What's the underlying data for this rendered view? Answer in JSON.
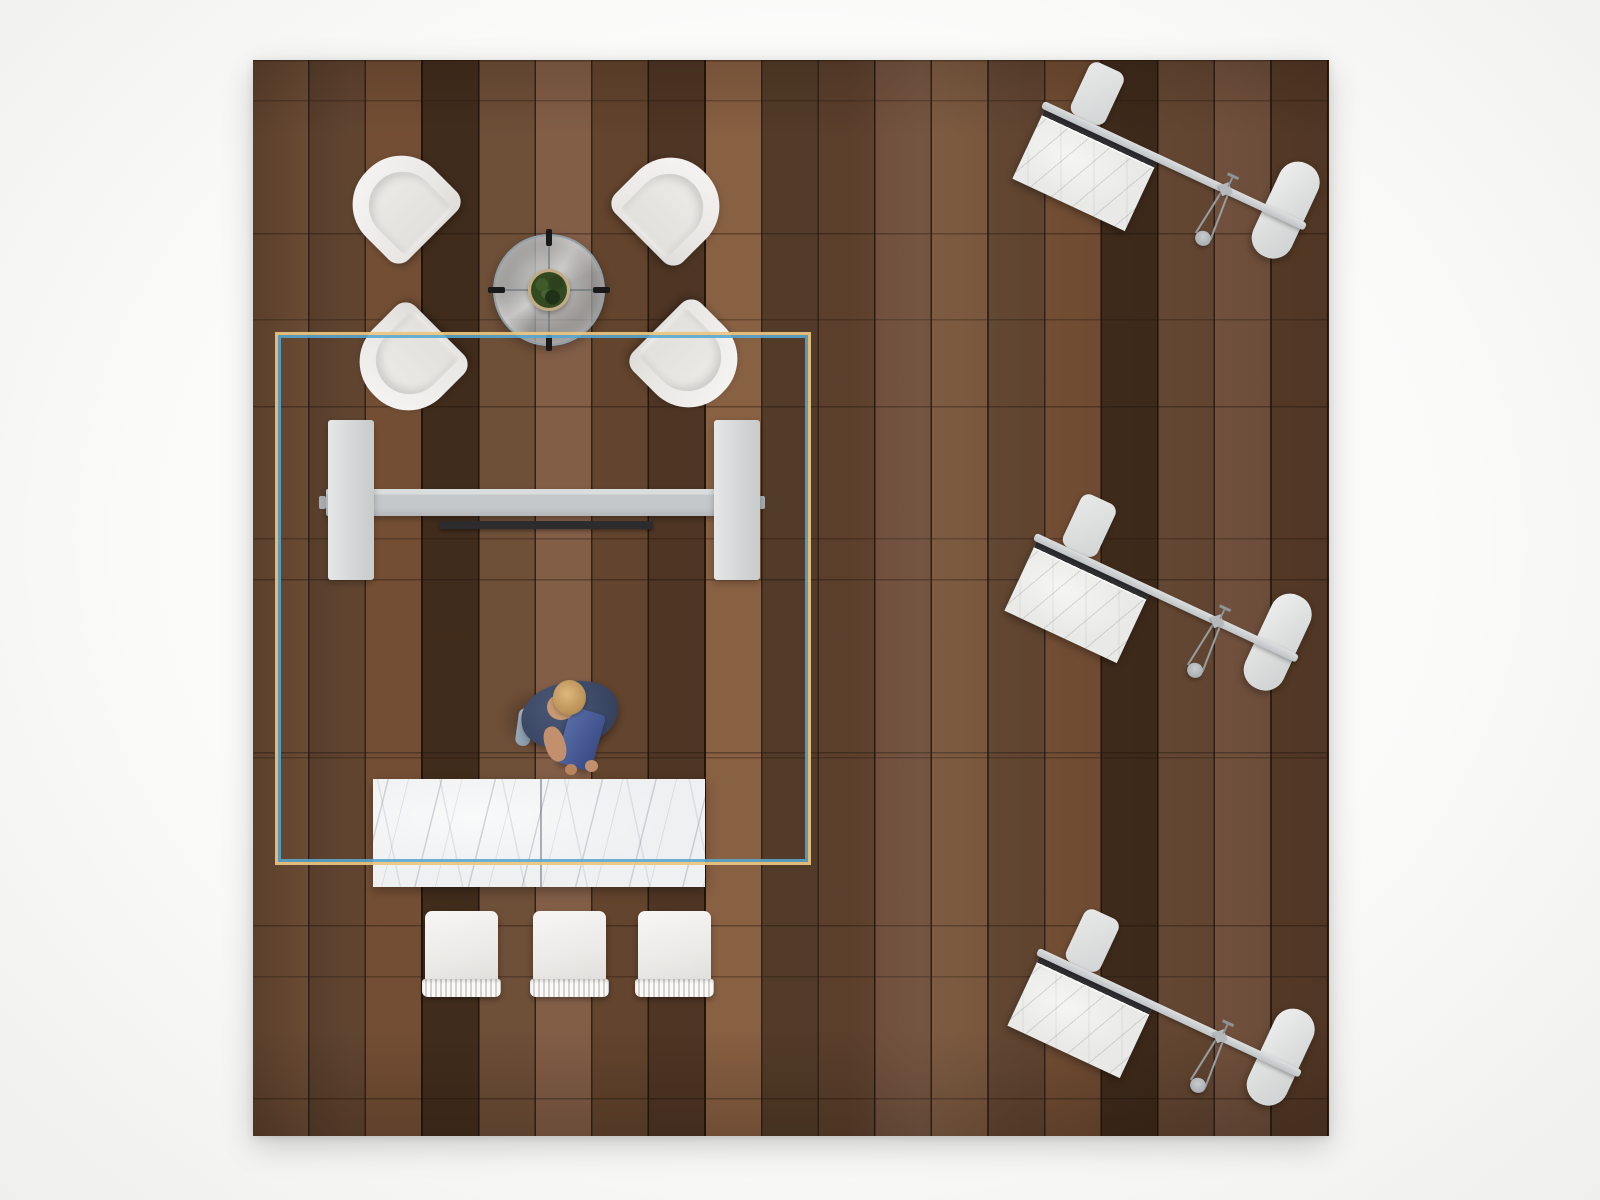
{
  "scene": {
    "type": "top-down 3D interior render",
    "floor": {
      "material": "walnut-plank",
      "plank_orientation": "vertical",
      "base_color": "#5d4130",
      "plank_line_color": "#241710"
    },
    "glass_room": {
      "shape": "square",
      "glass_color": "#57a6cf",
      "frame_color": "#ecc57f"
    },
    "lounge": {
      "armchair_count": 4,
      "armchair_color": "#f2f1ee",
      "coffee_table": {
        "shape": "round",
        "material": "glass",
        "rim_color": "#8fa0a8",
        "tick_color": "#191919",
        "plant_color": "#33491f",
        "pot_color": "#d9c49c"
      }
    },
    "workbench": {
      "beam_color": "#c4c8ca",
      "panel_count": 2,
      "panel_color": "#d8dbdb",
      "dark_bar_color": "#2c2c2e"
    },
    "person": {
      "count": 1,
      "shirt_color": "#3c4966",
      "hair_color": "#c9a265",
      "carried_item_color": "#41548f",
      "shoe_color": "#9fb2c2"
    },
    "counter": {
      "material": "marble",
      "color": "#eef0f1",
      "seat_count": 3
    },
    "workstations": {
      "count": 3,
      "rotation_deg": 25,
      "top_material": "stone-marble",
      "edge_color": "#313134",
      "rail_color": "#c8cbcd",
      "bench_color": "#e2e4e3",
      "lamp_color": "#a9aeb1"
    }
  },
  "palette": {
    "background": "#f7f7f5",
    "floor_dark_plank": "#47311f",
    "floor_light_plank": "#81583b",
    "white_furniture": "#f2f1ee",
    "glass_blue": "#57a6cf",
    "frame_gold": "#ecc57f"
  }
}
